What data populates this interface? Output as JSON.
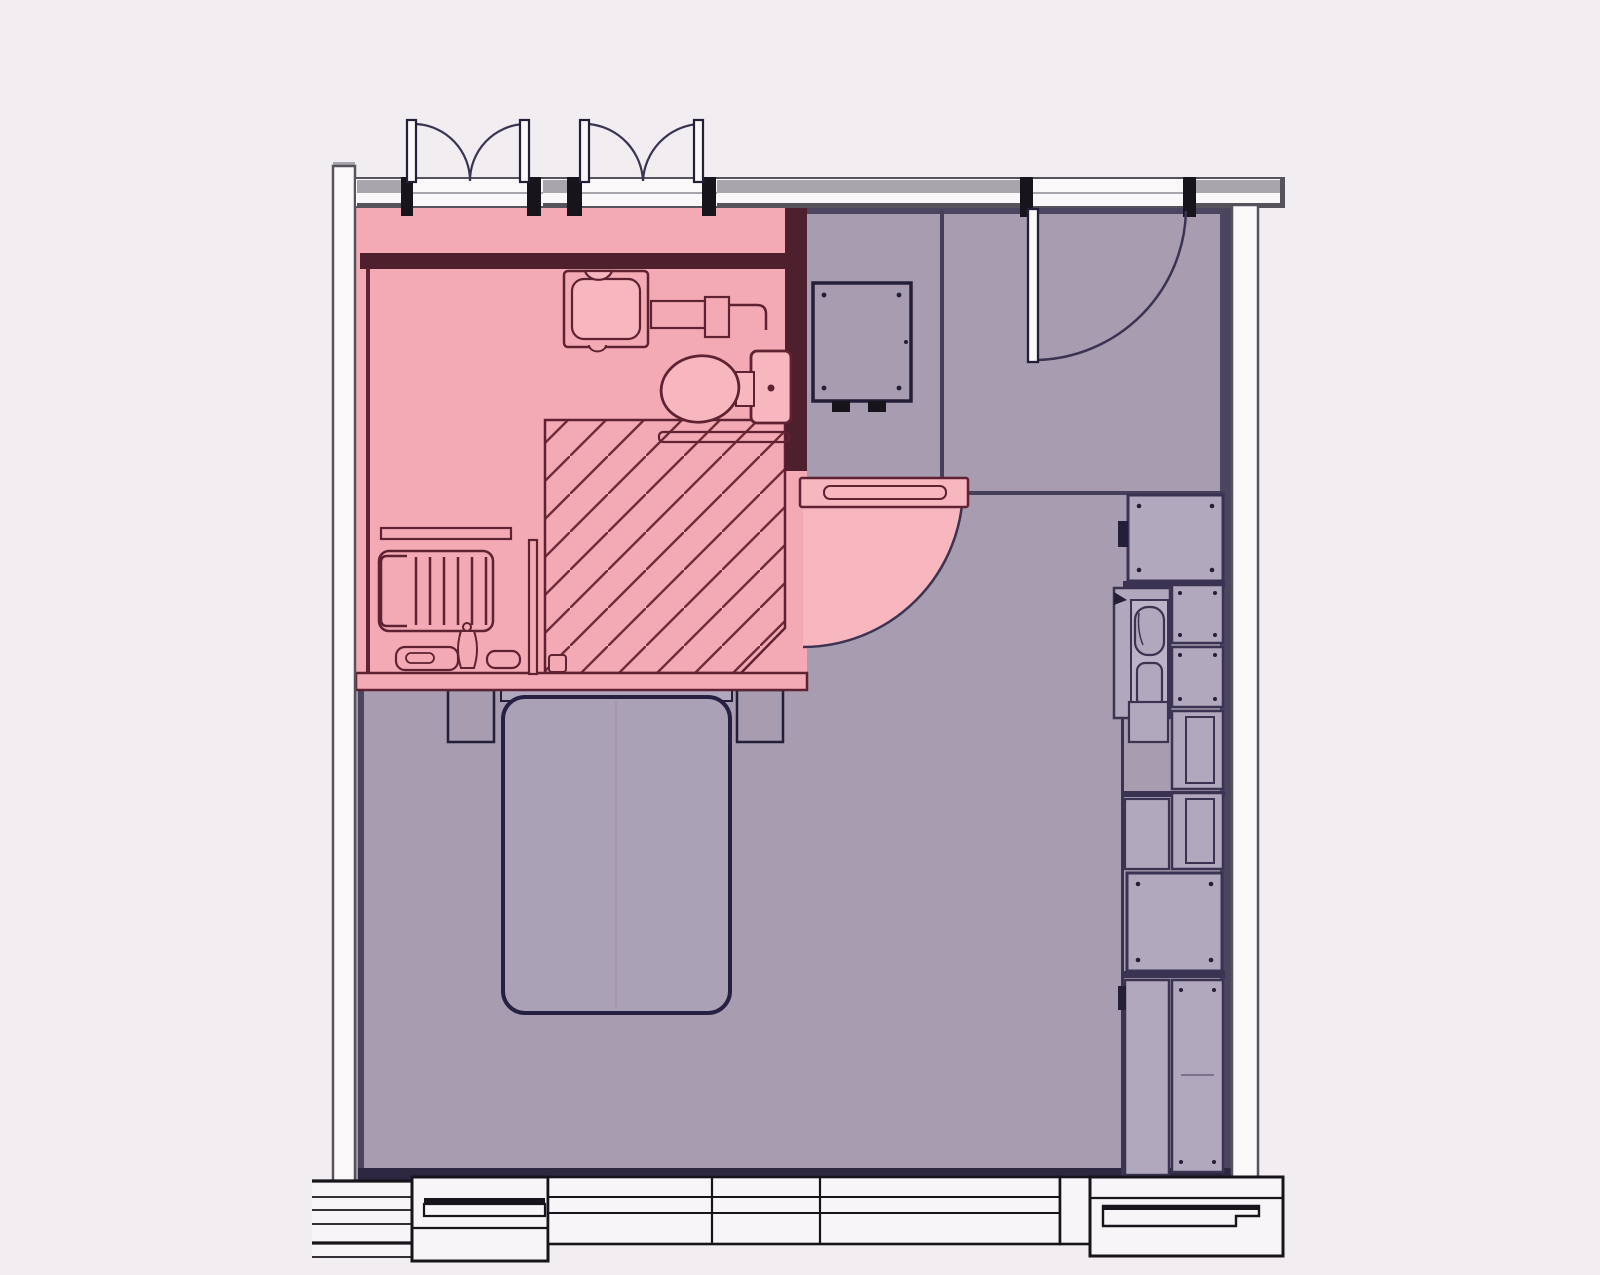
{
  "title": "architectural-floor-plan",
  "palette": {
    "bg": "#f2edf1",
    "room": "#a79cb0",
    "room_light": "#b2a8bd",
    "bed": "#aba1b6",
    "pink": "#f4aab4",
    "pink_bright": "#f8b6bf",
    "maroon": "#4e1f2d",
    "maroon_line": "#5e2232",
    "hatch": "#6e2c3b",
    "ink": "#241f38",
    "slate": "#3a3452",
    "shadow": "#4c4560",
    "wall_gray": "#a9a5ad",
    "wall_line": "#56535d",
    "wall_fill": "#fbf8fa",
    "win_line": "#17141c",
    "win_fill": "#f8f5f8",
    "crease": "#998ea8"
  },
  "plan": {
    "type": "floor-plan",
    "highlighted_zone": "bathroom",
    "zones": [
      {
        "name": "bathroom",
        "fill_key": "pink"
      },
      {
        "name": "bedroom",
        "fill_key": "room"
      }
    ],
    "fixtures": [
      "french-doors-left",
      "french-doors-right",
      "entry-door",
      "bathroom-door",
      "washbasin",
      "toilet",
      "shower-hatched-area",
      "towel-radiator",
      "vanity-tray",
      "grab-bar",
      "wall-cabinet",
      "bed",
      "nightstand-left",
      "nightstand-right",
      "kitchenette-sink",
      "storage-cabinets",
      "window-band"
    ]
  }
}
